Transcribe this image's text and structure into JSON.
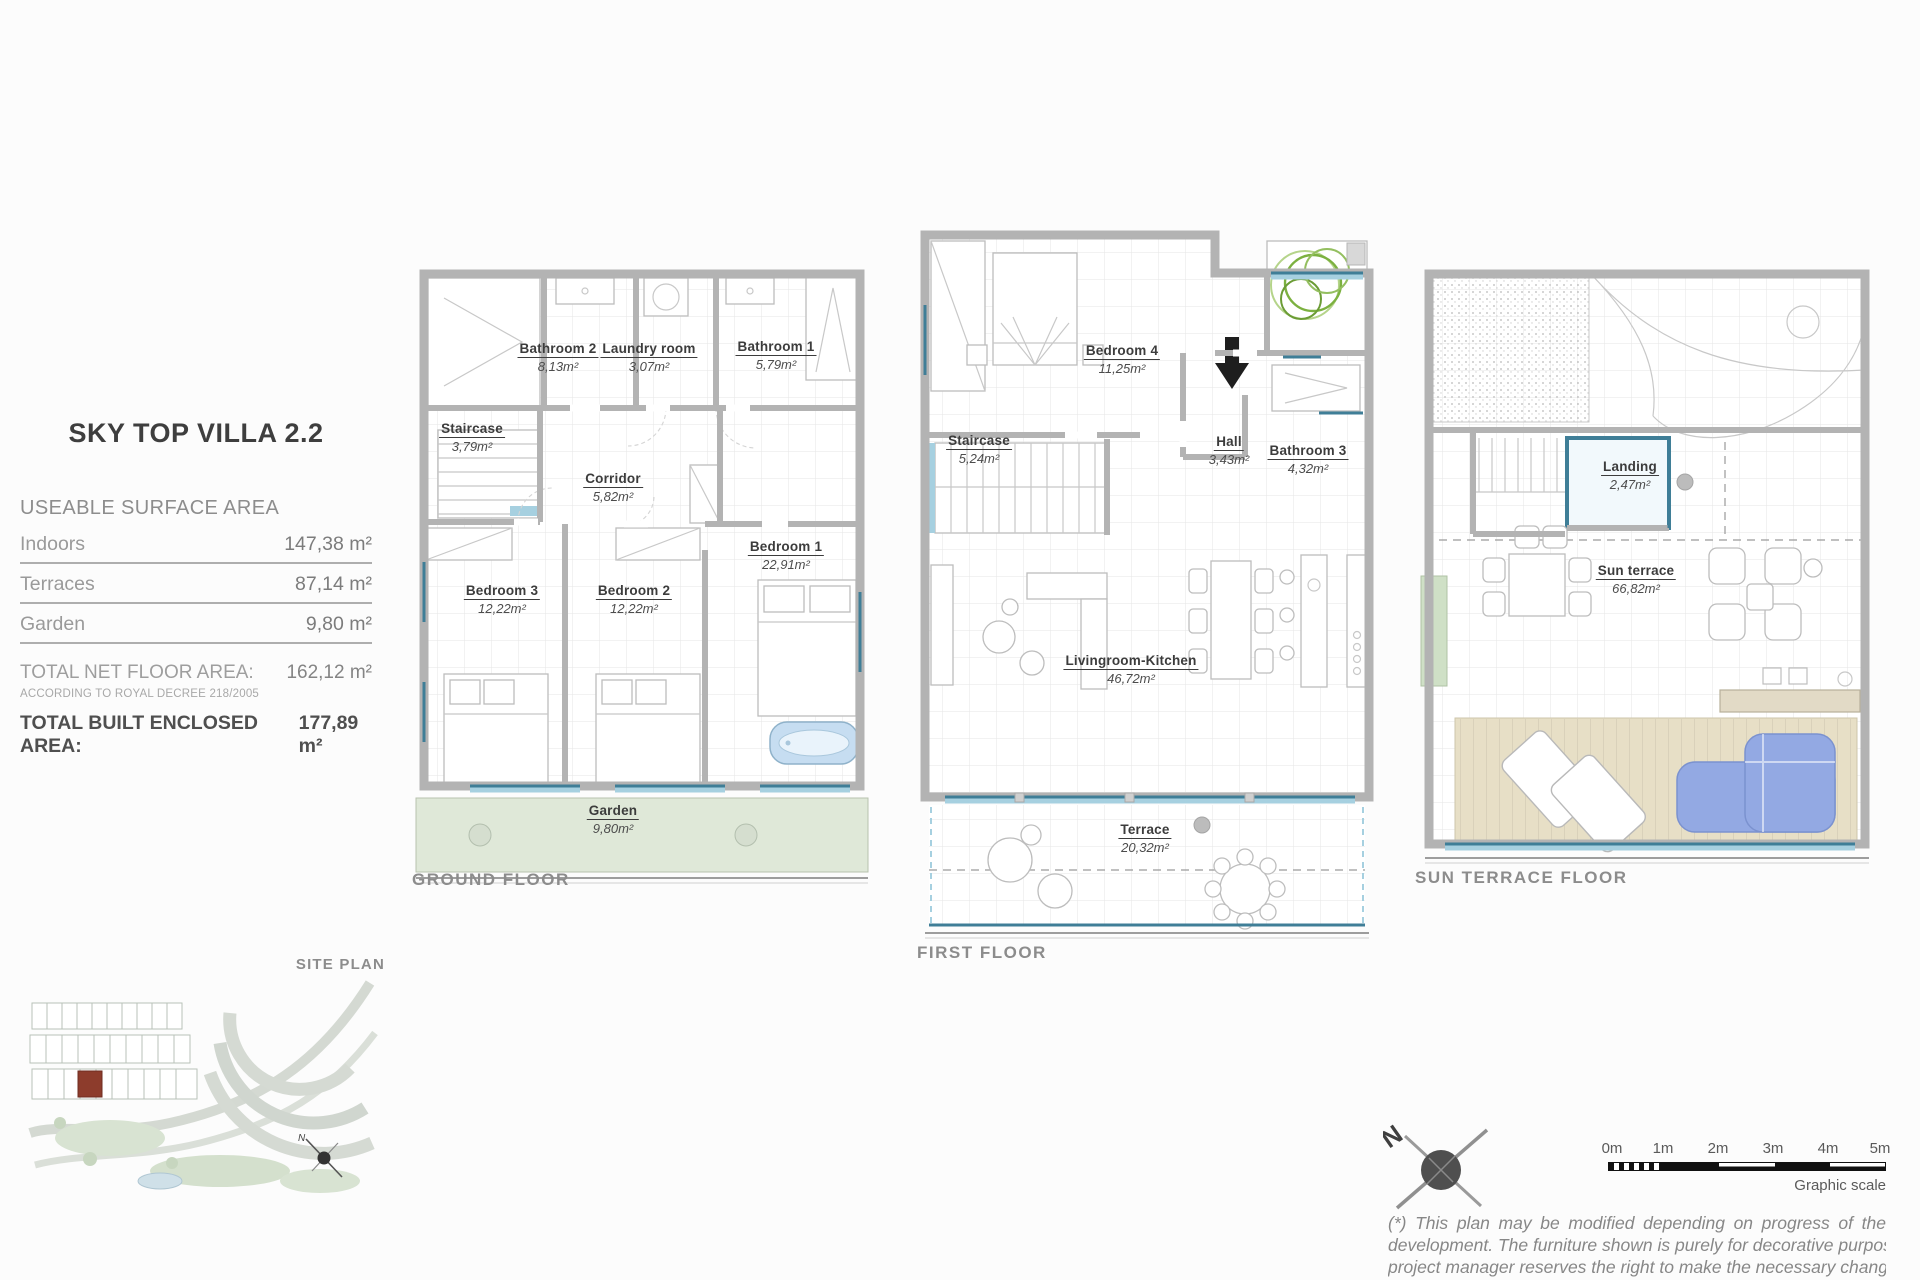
{
  "colors": {
    "wall": "#b3b3b3",
    "teal": "#3f7e97",
    "teal_light": "#a6d0e0",
    "garden": "#dfe8d8",
    "deck": "#e7dfc6",
    "sofa": "#93a9e3",
    "bath": "#c6ddf1",
    "plant": "#7cb140",
    "site_red": "#8d3c2c"
  },
  "left_panel": {
    "title": "SKY TOP VILLA 2.2",
    "surface_header": "USEABLE SURFACE AREA",
    "rows": [
      {
        "label": "Indoors",
        "value": "147,38 m²"
      },
      {
        "label": "Terraces",
        "value": "87,14 m²"
      },
      {
        "label": "Garden",
        "value": "9,80 m²"
      }
    ],
    "total_net_label": "TOTAL NET FLOOR AREA:",
    "total_net_value": "162,12  m²",
    "total_net_note": "ACCORDING TO ROYAL DECREE 218/2005",
    "total_built_label": "TOTAL BUILT ENCLOSED AREA:",
    "total_built_value": "177,89 m²"
  },
  "floors": [
    {
      "name": "GROUND FLOOR",
      "rooms": [
        {
          "name": "Bathroom 2",
          "area": "8,13m²"
        },
        {
          "name": "Laundry room",
          "area": "3,07m²"
        },
        {
          "name": "Bathroom 1",
          "area": "5,79m²"
        },
        {
          "name": "Staircase",
          "area": "3,79m²"
        },
        {
          "name": "Corridor",
          "area": "5,82m²"
        },
        {
          "name": "Bedroom 1",
          "area": "22,91m²"
        },
        {
          "name": "Bedroom 3",
          "area": "12,22m²"
        },
        {
          "name": "Bedroom 2",
          "area": "12,22m²"
        },
        {
          "name": "Garden",
          "area": "9,80m²"
        }
      ]
    },
    {
      "name": "FIRST FLOOR",
      "rooms": [
        {
          "name": "Bedroom 4",
          "area": "11,25m²"
        },
        {
          "name": "Staircase",
          "area": "5,24m²"
        },
        {
          "name": "Hall",
          "area": "3,43m²"
        },
        {
          "name": "Bathroom 3",
          "area": "4,32m²"
        },
        {
          "name": "Livingroom-Kitchen",
          "area": "46,72m²"
        },
        {
          "name": "Terrace",
          "area": "20,32m²"
        }
      ]
    },
    {
      "name": "SUN TERRACE FLOOR",
      "rooms": [
        {
          "name": "Landing",
          "area": "2,47m²"
        },
        {
          "name": "Sun terrace",
          "area": "66,82m²"
        }
      ]
    }
  ],
  "site_plan": {
    "label": "SITE PLAN"
  },
  "compass": {
    "label": "N"
  },
  "scale_bar": {
    "ticks": [
      "0m",
      "1m",
      "2m",
      "3m",
      "4m",
      "5m"
    ],
    "caption": "Graphic scale"
  },
  "disclaimer": {
    "lines": [
      "(*) This plan may be modified depending on progress of the",
      "development. The furniture shown is purely for decorative purposes. The",
      "project manager reserves the right to make the necessary changes for",
      "any possible functional, aesthetic and legal reasons, without this"
    ]
  }
}
